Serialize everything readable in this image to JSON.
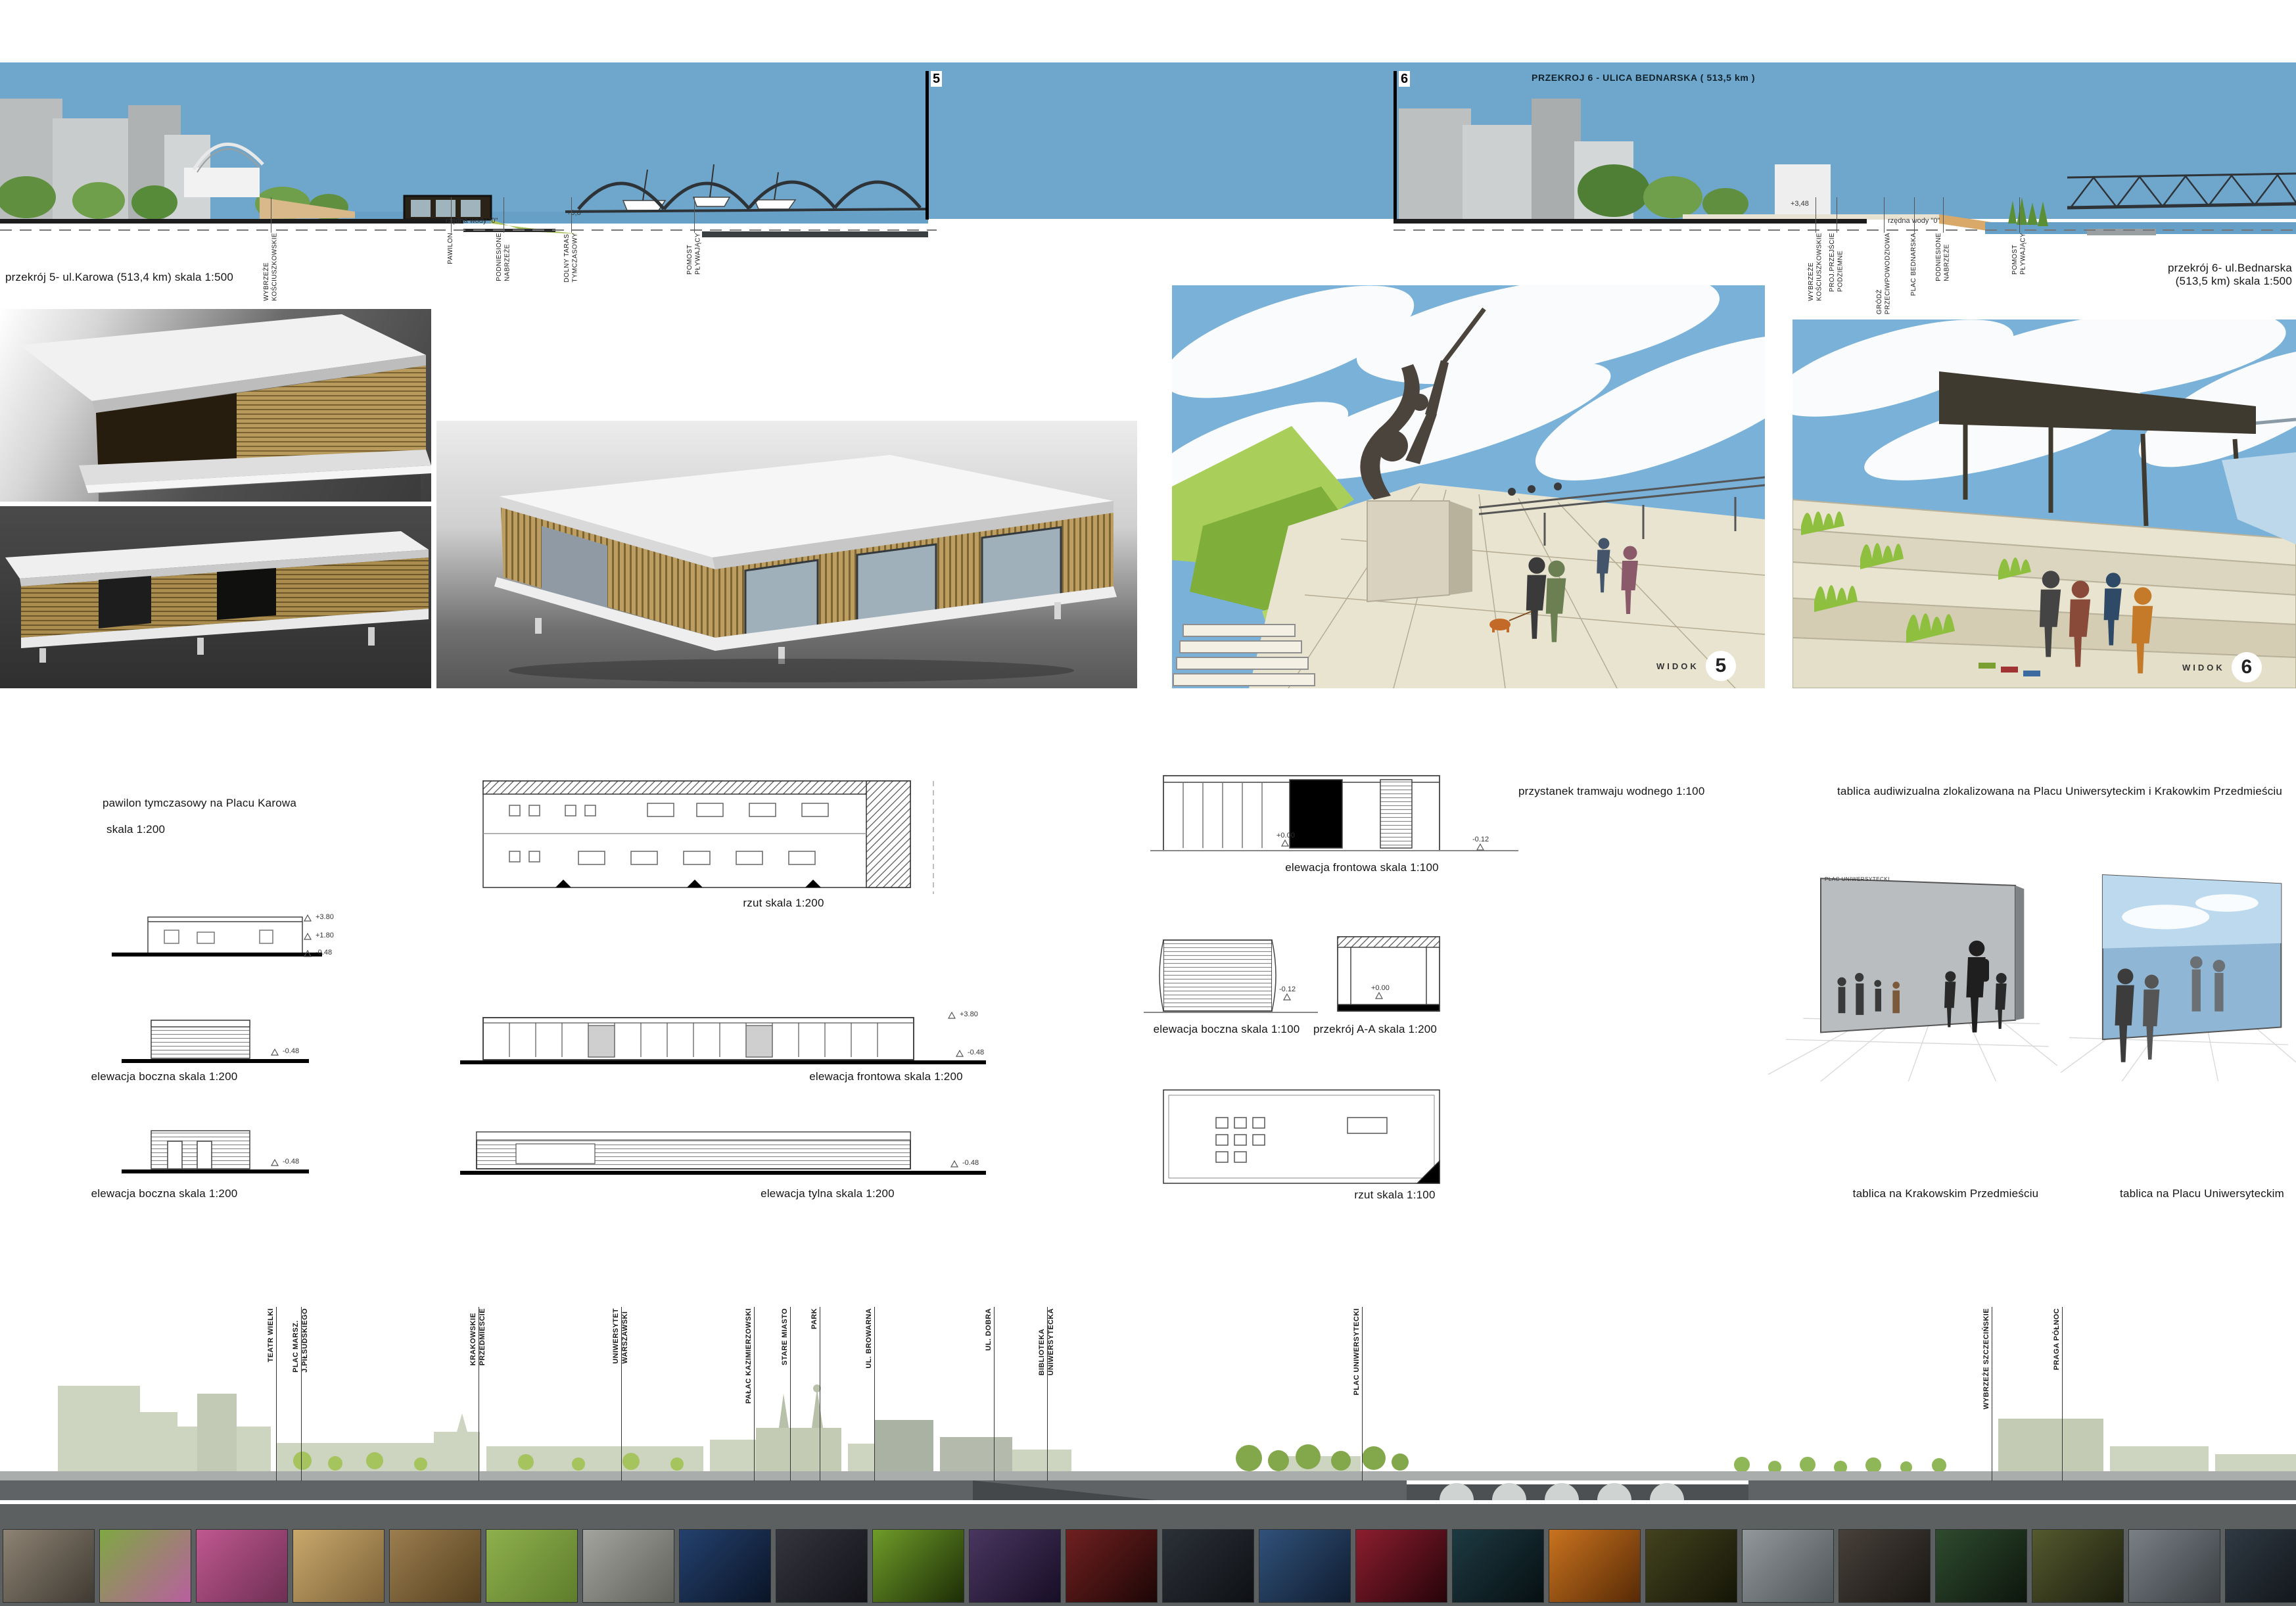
{
  "section5": {
    "marker": "5",
    "caption": "przekrój 5- ul.Karowa (513,4 km) skala 1:500",
    "water_note": "rzędna wody \"0\"",
    "level_note": "+0,8",
    "labels": [
      "WYBRZEŻE\nKOŚCIUSZKOWSKIE",
      "PAWILON",
      "PODNIESIONE\nNABRZEŻE",
      "DOLNY TARAS\nTYMCZASOWY",
      "POMOST\nPŁYWAJĄCY"
    ]
  },
  "section6": {
    "marker": "6",
    "title": "PRZEKROJ 6 - ULICA BEDNARSKA ( 513,5 km )",
    "caption_line1": "przekrój 6- ul.Bednarska",
    "caption_line2": "(513,5 km) skala 1:500",
    "water_note": "rzędna wody \"0\"",
    "level_note": "+3,48",
    "labels": [
      "WYBRZEŻE\nKOŚCIUSZKOWSKIE",
      "PROJ.PRZEJŚCIE\nPODZIEMNE",
      "GRÓDŻ\nPRZECIWPOWODZIOWA",
      "PLAC BEDNARSKA",
      "PODNIESIONE\nNABRZEŻE",
      "POMOST\nPŁYWAJĄCY"
    ]
  },
  "views": {
    "v5": {
      "label": "WIDOK",
      "number": "5"
    },
    "v6": {
      "label": "WIDOK",
      "number": "6"
    }
  },
  "pawilon": {
    "title_line1": "pawilon tymczasowy na Placu Karowa",
    "title_line2": "skala 1:200",
    "cap_rzut": "rzut skala 1:200",
    "cap_boczna1": "elewacja boczna skala 1:200",
    "cap_frontowa": "elewacja frontowa skala 1:200",
    "cap_boczna2": "elewacja boczna skala 1:200",
    "cap_tylna": "elewacja tylna skala 1:200",
    "levels": {
      "l1": "+3.80",
      "l2": "+1.80",
      "l3": "-0.48"
    }
  },
  "przystanek": {
    "title": "przystanek tramwaju wodnego 1:100",
    "cap_frontowa": "elewacja frontowa skala 1:100",
    "cap_boczna": "elewacja boczna skala 1:100",
    "cap_przekroj": "przekrój A-A skala 1:200",
    "cap_rzut": "rzut skala 1:100",
    "levels": {
      "zero": "+0.00",
      "minus": "-0.12"
    }
  },
  "tablica": {
    "title": "tablica audiwizualna zlokalizowana na Placu Uniwersyteckim i Krakowkim Przedmieściu",
    "cap_left": "tablica na Krakowskim Przedmieściu",
    "cap_right": "tablica na Placu Uniwersyteckim",
    "board_label": "PLAC UNIWERSYTECKI"
  },
  "panorama": {
    "labels": [
      "TEATR WIELKI",
      "PLAC MARSZ.\nJ.PIŁSUDSKIEGO",
      "KRAKOWSKIE\nPRZEDMIESCIE",
      "UNIWERSYTET\nWARSZAWSKI",
      "PAŁAC KAZIMIERZOWSKI",
      "STARE MIASTO",
      "PARK",
      "UL. BROWARNA",
      "UL. DOBRA",
      "BIBLIOTEKA\nUNIWERSYTECKA",
      "PLAC UNIWERSYTECKI",
      "WYBRZEŻE SZCZECIŃSKIE",
      "PRAGA PÓŁNOC"
    ]
  },
  "colors": {
    "sky": "#6FA6CB",
    "water": "#66A0C6",
    "panorama_building": "#CDD4C0",
    "ground_dark": "#5F6365",
    "accent_green": "#9CC050"
  },
  "filmstrip": {
    "tiles": [
      {
        "c1": "#8e8374",
        "c2": "#3f3a32"
      },
      {
        "c1": "#7fa843",
        "c2": "#b85f9e"
      },
      {
        "c1": "#c0588f",
        "c2": "#6e2f54"
      },
      {
        "c1": "#c9a86b",
        "c2": "#7c6238"
      },
      {
        "c1": "#9c7e4f",
        "c2": "#55401f"
      },
      {
        "c1": "#8fb04d",
        "c2": "#5f7d2c"
      },
      {
        "c1": "#a3a49e",
        "c2": "#60615b"
      },
      {
        "c1": "#24416e",
        "c2": "#0a1426"
      },
      {
        "c1": "#35353f",
        "c2": "#121218"
      },
      {
        "c1": "#6f9c2a",
        "c2": "#1d2d06"
      },
      {
        "c1": "#4a3660",
        "c2": "#170e26"
      },
      {
        "c1": "#702020",
        "c2": "#1d0606"
      },
      {
        "c1": "#2c3138",
        "c2": "#0e1014"
      },
      {
        "c1": "#31527a",
        "c2": "#0f1c30"
      },
      {
        "c1": "#8c1e30",
        "c2": "#260409"
      },
      {
        "c1": "#1d3a42",
        "c2": "#060f12"
      },
      {
        "c1": "#c9731f",
        "c2": "#572a06"
      },
      {
        "c1": "#43431f",
        "c2": "#151507"
      },
      {
        "c1": "#91989b",
        "c2": "#4f5659"
      },
      {
        "c1": "#48413a",
        "c2": "#191613"
      },
      {
        "c1": "#2f4b2f",
        "c2": "#0d160d"
      },
      {
        "c1": "#555a2e",
        "c2": "#1c1e0e"
      },
      {
        "c1": "#7a8086",
        "c2": "#3a3e42"
      },
      {
        "c1": "#303a44",
        "c2": "#0e1216"
      }
    ]
  }
}
